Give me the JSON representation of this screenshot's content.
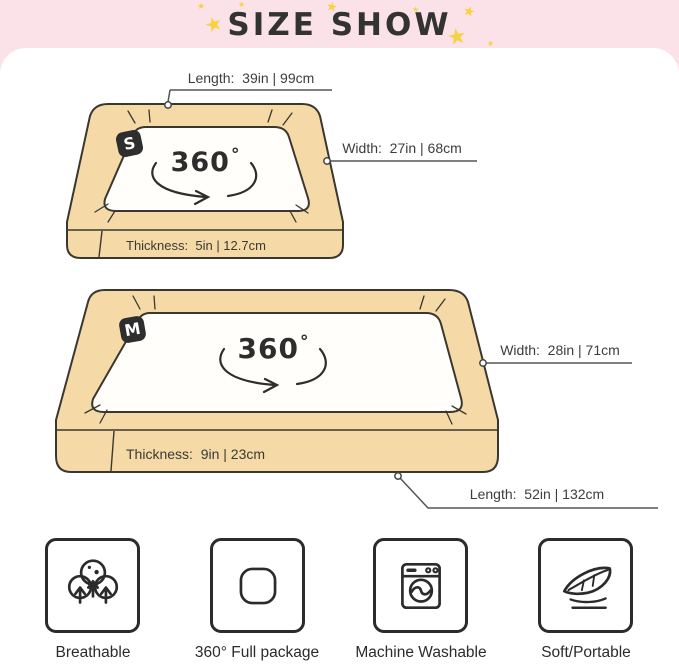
{
  "header": {
    "title": "SIZE SHOW",
    "star_glyph": "★"
  },
  "diagram": {
    "small_bed": {
      "badge": "S",
      "rotation": "360",
      "degree_symbol": "°",
      "length_label": "Length:  39in | 99cm",
      "width_label": "Width:  27in | 68cm",
      "thickness_label": "Thickness:  5in | 12.7cm"
    },
    "medium_bed": {
      "badge": "M",
      "rotation": "360",
      "degree_symbol": "°",
      "width_label": "Width:  28in | 71cm",
      "thickness_label": "Thickness:  9in | 23cm",
      "length_label": "Length:  52in | 132cm"
    }
  },
  "features": [
    {
      "icon": "breathable-icon",
      "label": "Breathable"
    },
    {
      "icon": "full-package-icon",
      "label": "360° Full package"
    },
    {
      "icon": "machine-washable-icon",
      "label": "Machine Washable"
    },
    {
      "icon": "soft-portable-icon",
      "label": "Soft/Portable"
    }
  ],
  "colors": {
    "header_pink": "#FBE2E8",
    "star_yellow": "#F6D243",
    "bed_fill": "#F5DAA8",
    "outline_dark": "#3A372E",
    "text_dark": "#3D3D3D"
  }
}
